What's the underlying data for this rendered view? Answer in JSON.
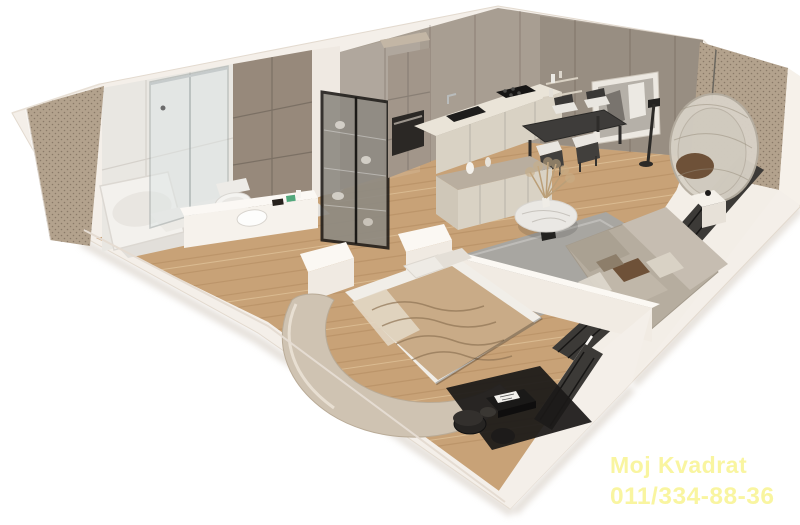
{
  "watermark": {
    "line1": "Moj Kvadrat",
    "line2": "011/334-88-36",
    "color": "#f9f5a0"
  },
  "palette": {
    "bg": "#ffffff",
    "outerWall": "#f4efe9",
    "wood": "#c8a277",
    "woodStreak": "#aa8157",
    "concrete": "#a89e92",
    "tileWhite": "#e9e7e2",
    "tileTaupe": "#97897b",
    "panelBeige": "#b3a28d",
    "glass": "#dfe6e6",
    "cream": "#d9d2c4",
    "counterTop": "#eae4d8",
    "tallCabinet": "#a2968a",
    "darkFurniture": "#3e3c3a",
    "radiator": "#3c3a37",
    "rugGray": "#a8a6a1",
    "rugDark": "#1b1918",
    "sofaBase": "#b6ad9f",
    "sofaBack": "#c6bdb1",
    "blanket": "#c9ab87",
    "marble": "#eae8e4",
    "eggChair": "#d8d2c7",
    "cushionBrown": "#6e5138",
    "chairSeat": "#e9e6e0",
    "artwork": "#b5b0a8",
    "bathFloor": "#e2dfda",
    "white": "#f6f2ec"
  },
  "scene": {
    "type": "3d-apartment-floor-plan-render",
    "rooms": [
      {
        "name": "bathroom",
        "items": [
          "bathtub",
          "glass shower",
          "wall-hung toilet",
          "washbasin counter",
          "taupe accent tile wall"
        ]
      },
      {
        "name": "hallway",
        "items": [
          "glass display cabinet",
          "wood floor"
        ]
      },
      {
        "name": "kitchen",
        "items": [
          "tall cabinets",
          "built-in oven",
          "black sink",
          "cooktop",
          "island sideboard"
        ]
      },
      {
        "name": "dining-area",
        "items": [
          "dark dining table",
          "four chairs",
          "wall shelves",
          "framed artwork"
        ]
      },
      {
        "name": "living-room",
        "items": [
          "gray rug",
          "round marble coffee table",
          "corner sofa",
          "hanging egg chair",
          "floor lamp",
          "radiators",
          "side table"
        ]
      },
      {
        "name": "bedroom",
        "items": [
          "double bed",
          "curved upholstered frame",
          "dark rug",
          "black low table",
          "poufs",
          "radiator"
        ]
      }
    ]
  }
}
